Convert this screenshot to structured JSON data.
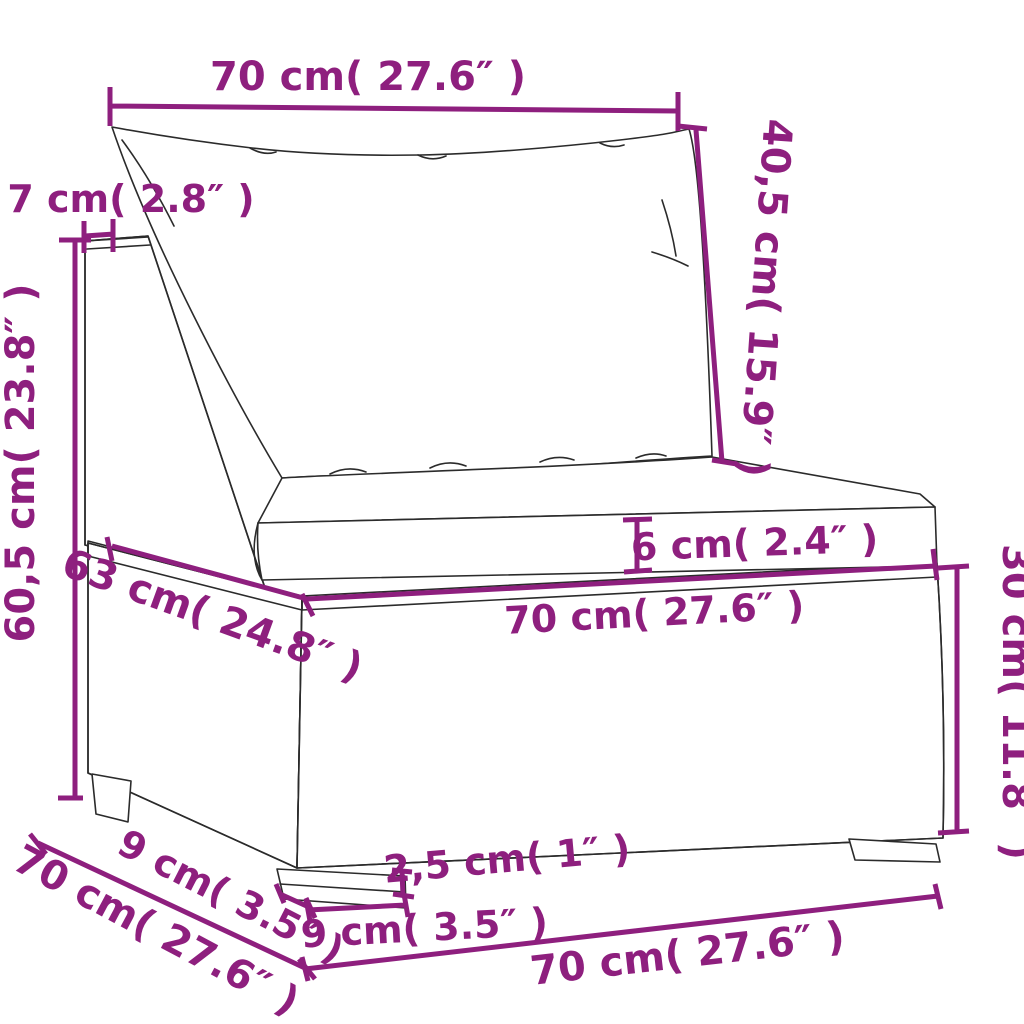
{
  "meta": {
    "title": "Rattan sofa section dimension diagram",
    "accent_color": "#8e1f7e",
    "line_color": "#2b2b2b",
    "background_color": "#ffffff"
  },
  "labels": {
    "top_width": "70 cm( 27.6″ )",
    "back_panel_thickness": "7 cm( 2.8″ )",
    "back_total_height": "60,5 cm( 23.8″ )",
    "back_cushion_height": "40,5 cm( 15.9″ )",
    "seat_cushion_thickness": "6 cm( 2.4″ )",
    "seat_width": "70 cm( 27.6″ )",
    "base_height": "30 cm( 11.8″ )",
    "seat_depth": "63 cm( 24.8″ )",
    "leg_inset_depth": "9 cm( 3.5″ )",
    "side_depth": "70 cm( 27.6″ )",
    "leg_height": "2,5 cm( 1″ )",
    "leg_width": "9 cm( 3.5″ )",
    "front_width": "70 cm( 27.6″ )"
  }
}
